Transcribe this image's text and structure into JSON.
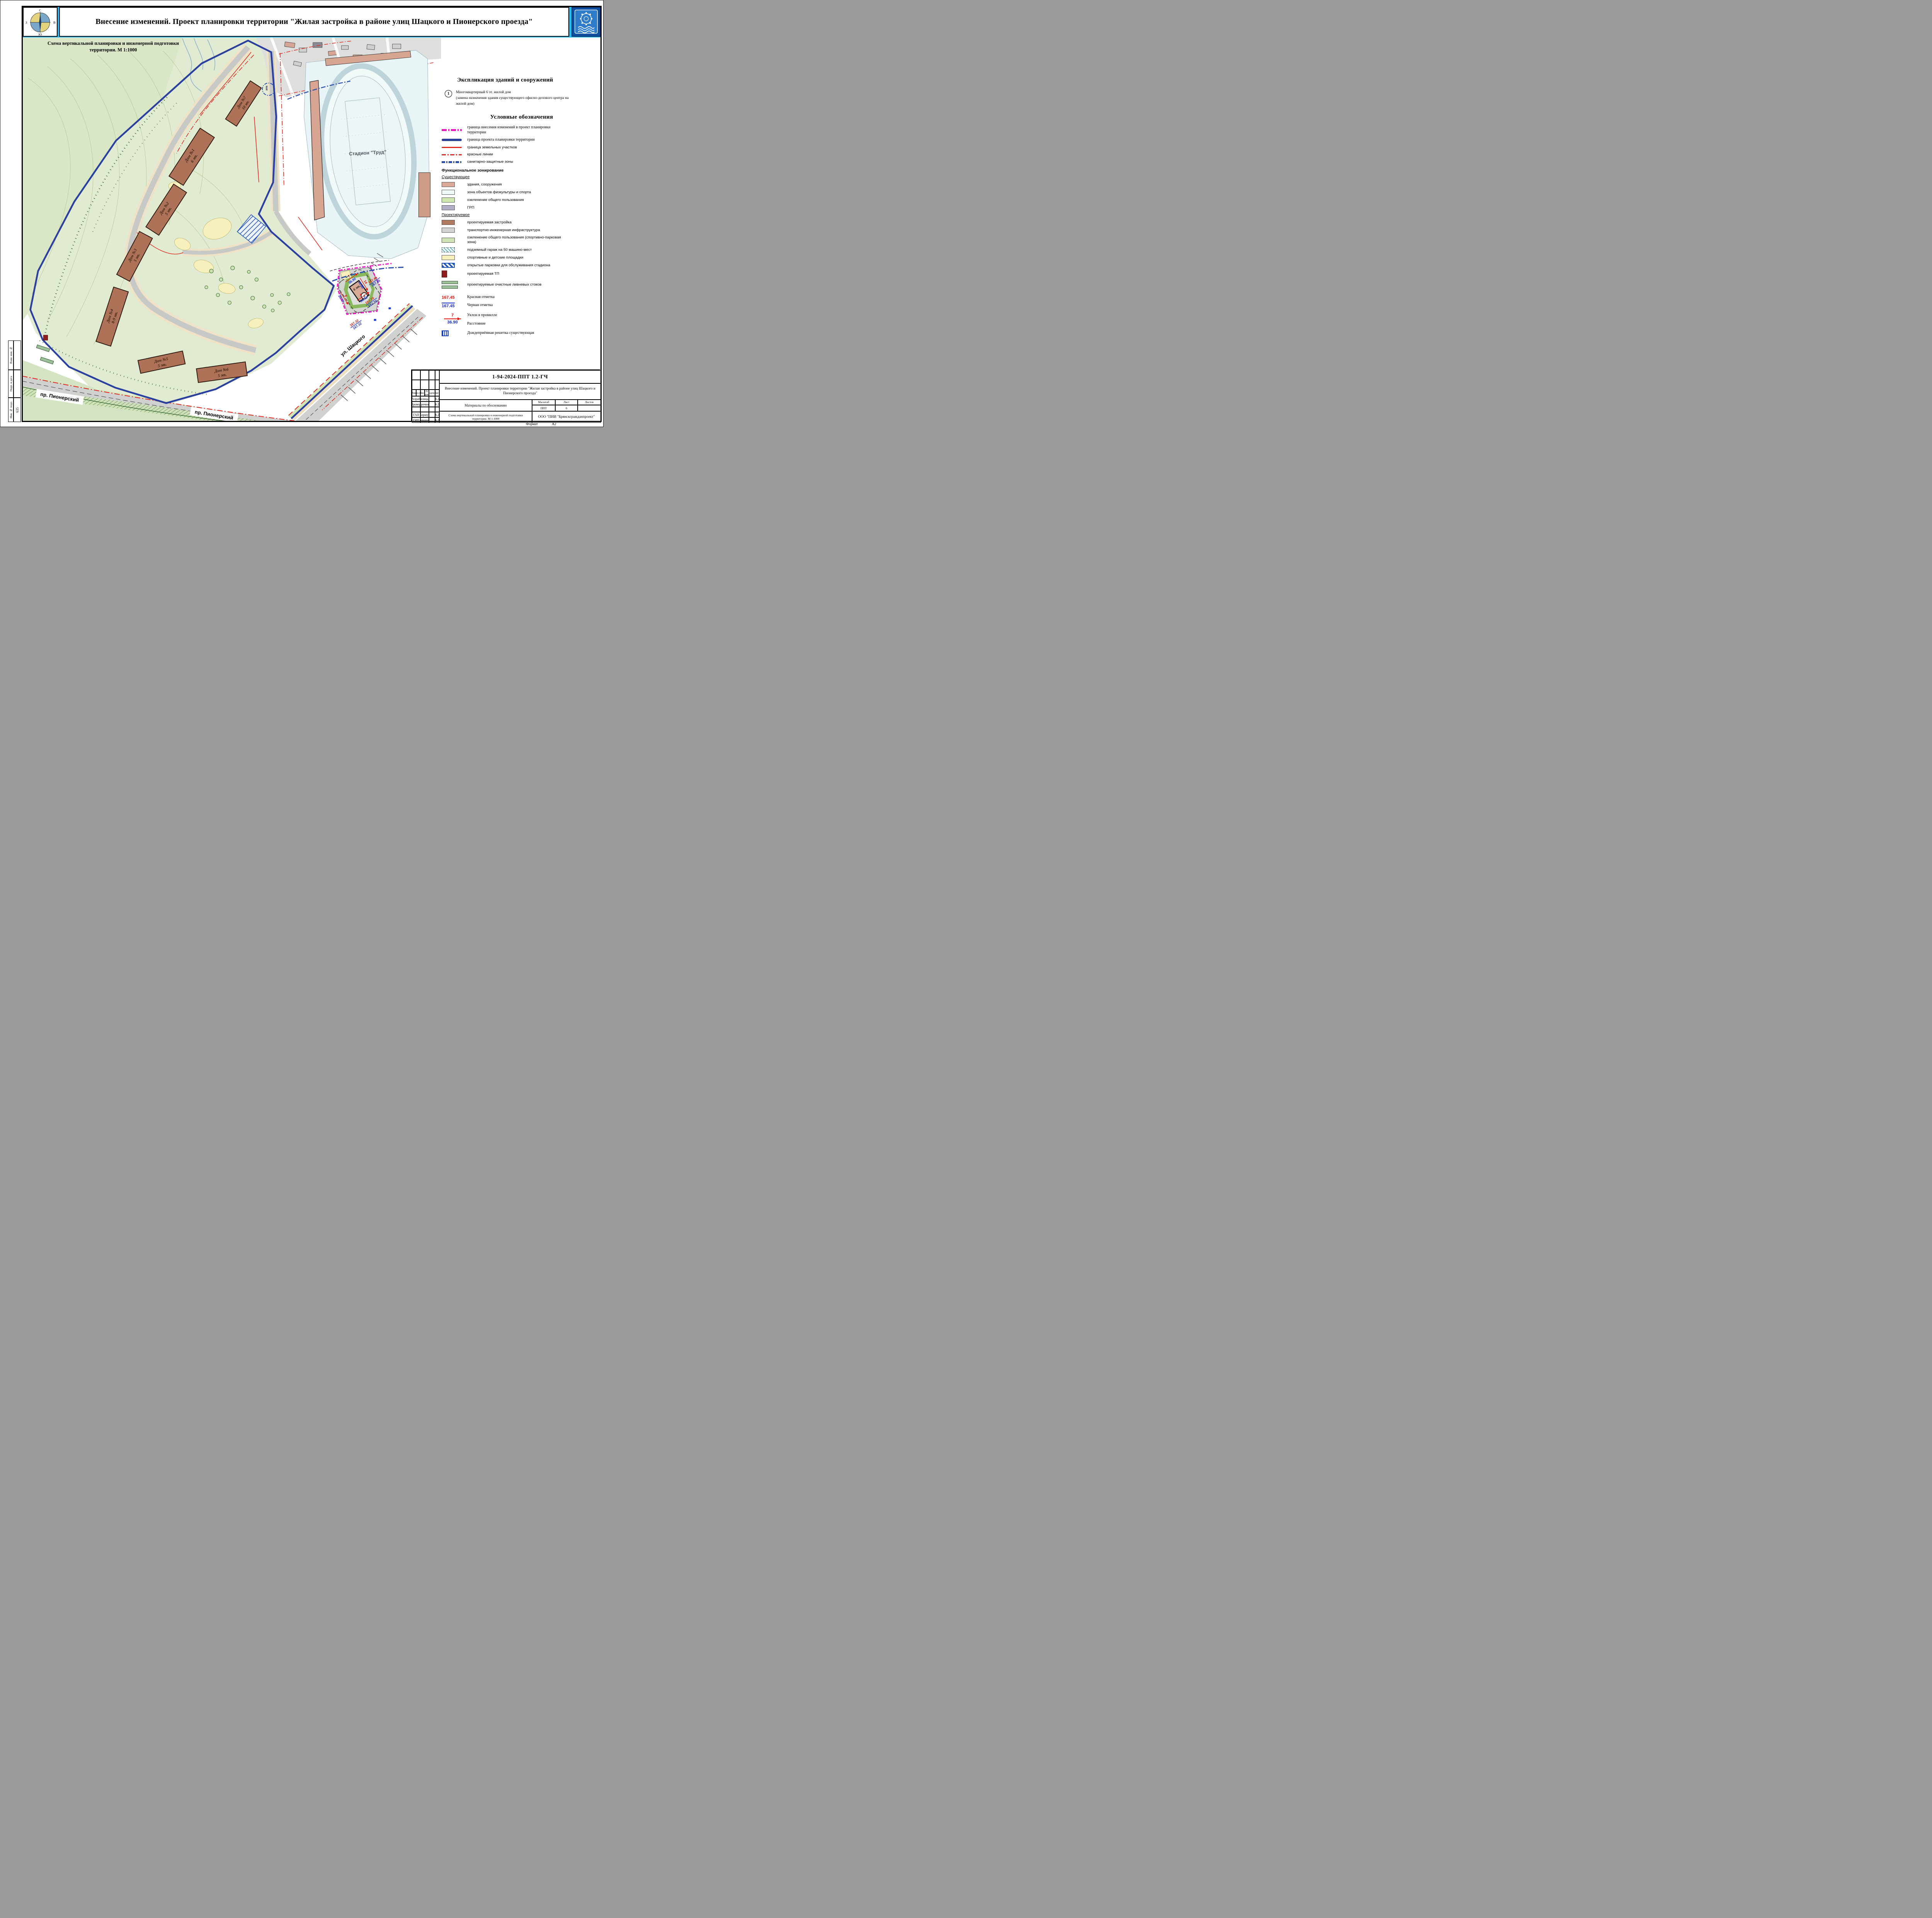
{
  "header": {
    "title": "Внесение изменений. Проект планировки территории \"Жилая застройка в районе улиц Шацкого и Пионерского проезда\"",
    "compass": {
      "n": "С",
      "e": "В",
      "s": "Ю",
      "w": "З"
    }
  },
  "map": {
    "subtitle1": "Схема вертикальной планировки и инженерной подготовки",
    "subtitle2": "территории.  М 1:1000",
    "stadium": "Стадион \"Труд\"",
    "street_pionersky": "пр. Пионерский",
    "street_shatskogo": "ул. Шацкого",
    "buildings": [
      {
        "name": "Дом №7",
        "floors": "10 эт."
      },
      {
        "name": "Дом №1",
        "floors": "6 эт."
      },
      {
        "name": "Дом №2",
        "floors": "5 эт."
      },
      {
        "name": "Дом №3",
        "floors": "5 эт."
      },
      {
        "name": "Дом №4",
        "floors": "8-9 эт."
      },
      {
        "name": "Дом №5",
        "floors": "5 эт."
      },
      {
        "name": "Дом №6",
        "floors": "5 эт."
      }
    ],
    "building1": {
      "badge": "1",
      "floors": "6 эт."
    },
    "elevation_marks": [
      {
        "red": "167.45",
        "black": "167.45"
      },
      {
        "red": "167.32",
        "black": "167.32"
      },
      {
        "red": "167.20",
        "black": "167.20"
      }
    ],
    "slope_marks": [
      {
        "slope": "7",
        "distance": "36.90"
      },
      {
        "slope": "14",
        "distance": "30.80"
      },
      {
        "slope": "9",
        "distance": "28.70"
      },
      {
        "slope": "4",
        "distance": "34.70"
      }
    ]
  },
  "explication": {
    "heading": "Экспликация зданий и сооружений",
    "item_number": "1",
    "line1": "Многоквартирный 6 эт. жилой дом",
    "line2": "(замена назначения здания существующего офисно-делового центра на",
    "line3": "жилой дом)"
  },
  "legend": {
    "heading": "Условные обозначения",
    "lines": [
      "граница внесения изменений в проект планировки территории",
      "граница проекта планировки территории",
      "граница земельных участков",
      "красные линии",
      "санитарно-защитные зоны"
    ],
    "zoning_heading": "Функциональное зонирование",
    "existing_heading": "Существующее",
    "existing": [
      "здания, сооружения",
      "зона объектов физкультуры и спорта",
      "озеленение общего пользования",
      "ГРП"
    ],
    "proposed_heading": "Проектируемое",
    "proposed": [
      "проектируемая застройка",
      "транспортно-инженерная инфраструктура",
      "озеленение общего пользования (спортивно-парковая зона)",
      "подземный гараж на 50 машино-мест",
      "спортивные и детские площадки",
      "открытые парковки для обслуживания стадиона",
      "проектируемая ТП",
      "проектируемые очистные ливневых стоков"
    ],
    "marks": {
      "red_value": "167.45",
      "red_label": "Красная отметка",
      "black_value": "167.45",
      "black_label": "Черная отметка",
      "slope_value": "7",
      "slope_label": "Уклон в промилле",
      "distance_value": "36.90",
      "distance_label": "Расстояние",
      "grate_label": "Дождеприёмная решетка существующая"
    }
  },
  "titleblock": {
    "doc_number": "1-94-2024-ППТ 1.2-ГЧ",
    "project_name": "Внесение изменений. Проект планировки территории \"Жилая застройка в районе улиц Шацкого и Пионерского проезда\"",
    "stage": "Материалы по обоснованию",
    "scheme_name": "Схема вертикальной планировки и инженерной подготовки территории. М 1:1000",
    "company": "ООО \"ПИИ \"Брянскгражданпроект\"",
    "cols": [
      "Изм.",
      "Кол.уч.",
      "Лист",
      "N док.",
      "Подпись",
      "Дата"
    ],
    "scale_label": "Масштаб",
    "scale_value": "ППТ",
    "sheet_label": "Лист",
    "sheet_value": "6",
    "sheets_label": "Листов",
    "rows": [
      {
        "role": "Разраб.",
        "name": "Столицына",
        "date": "06.24"
      },
      {
        "role": "Провер.",
        "name": "Курочкина",
        "date": "06.24"
      },
      {
        "role": "ГАП",
        "name": "Коршук",
        "date": "06.24"
      },
      {
        "role": "ГИП",
        "name": "Дорощин",
        "date": "06.24"
      }
    ]
  },
  "side_stamp": {
    "labels": [
      "Взам. инв. №",
      "Подп. и дата",
      "Инв. № подл."
    ],
    "inv_number": "635"
  },
  "footer": {
    "format_label": "Формат",
    "format_value": "А2"
  },
  "colors": {
    "header_cyan": "#29b9ef",
    "boundary_blue": "#2b3f9e",
    "change_magenta": "#f213c2",
    "red_line": "#e0281e",
    "sanitary_blue": "#2a4fae",
    "existing_building": "#d9a997",
    "proposed_building": "#b07a60",
    "sport_zone": "#eaf5f7",
    "greenery": "#cfe8b0",
    "grp_fill": "#b3aec7",
    "infrastructure": "#d2d3d0",
    "playground_yellow": "#f7f0bd",
    "parking_blue": "#2255bb",
    "tp_darkred": "#8f1f1f"
  }
}
